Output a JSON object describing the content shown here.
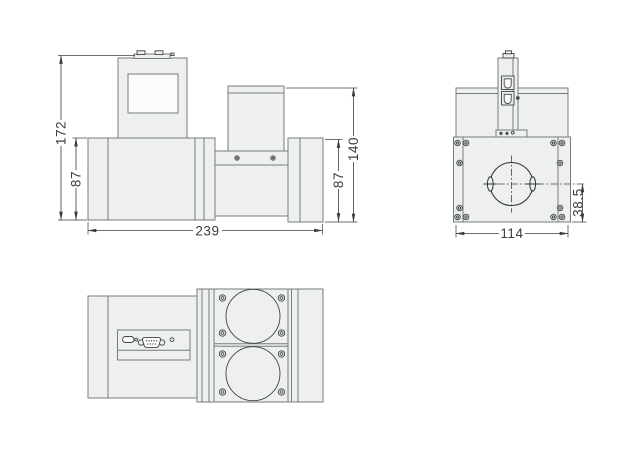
{
  "dimensions": {
    "front": {
      "total_height": "172",
      "left_body_height": "87",
      "total_width": "239",
      "right_total_height": "140",
      "right_body_height": "87"
    },
    "side": {
      "width": "114",
      "center_to_bottom": "38.5"
    }
  },
  "colors": {
    "background": "#ffffff",
    "part_fill": "#edf0ee",
    "part_stroke": "#767b7e",
    "detail_stroke": "#3e4347",
    "dark_fill": "#4b5054",
    "window_fill": "#fbfcfa",
    "dim_color": "#3c3c3c"
  }
}
